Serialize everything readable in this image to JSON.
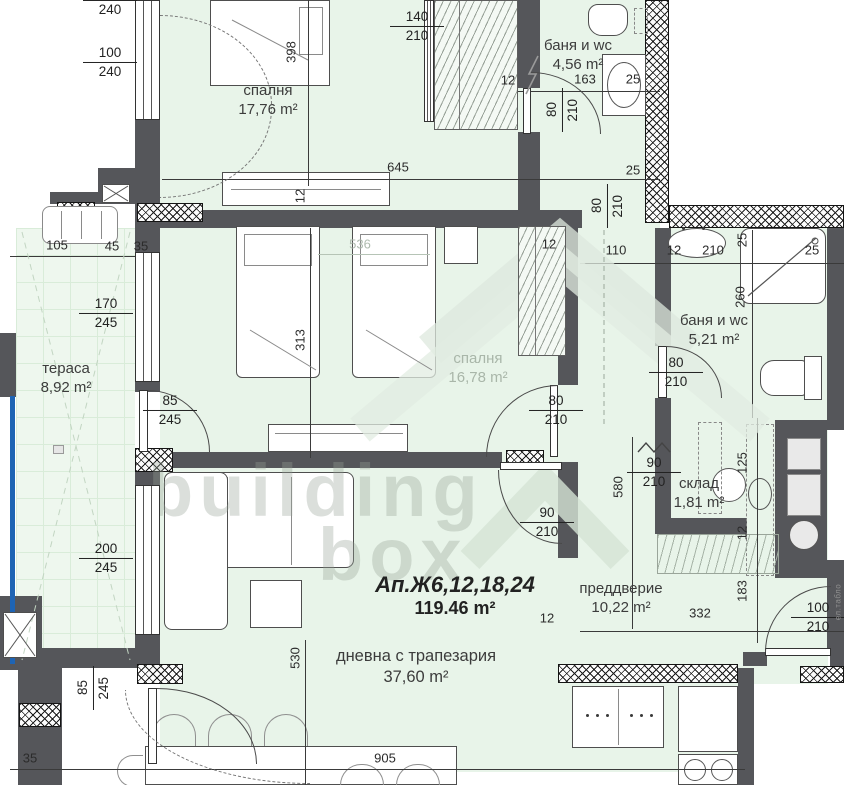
{
  "watermark": {
    "word1": "building",
    "word2": "box"
  },
  "title": {
    "apartment": "Ап.Ж6,12,18,24",
    "total_area": "119.46 m²"
  },
  "rooms": [
    {
      "name": "спалня",
      "area": "17,76 m²",
      "x": 268,
      "y": 82
    },
    {
      "name": "баня и wc",
      "area": "4,56 m²",
      "x": 578,
      "y": 37
    },
    {
      "name": "спалня",
      "area": "16,78 m²",
      "x": 478,
      "y": 350,
      "faded": true
    },
    {
      "name": "тераса",
      "area": "8,92 m²",
      "x": 66,
      "y": 360
    },
    {
      "name": "баня и wc",
      "area": "5,21 m²",
      "x": 714,
      "y": 312
    },
    {
      "name": "склад",
      "area": "1,81 m²",
      "x": 699,
      "y": 475
    },
    {
      "name": "преддверие",
      "area": "10,22 m²",
      "x": 621,
      "y": 580
    },
    {
      "name": "дневна с трапезария",
      "area": "37,60 m²",
      "x": 416,
      "y": 646,
      "big": true
    }
  ],
  "fractions": [
    {
      "num": "100",
      "den": "240",
      "x": 110,
      "y": 0
    },
    {
      "num": "100",
      "den": "240",
      "x": 110,
      "y": 62
    },
    {
      "num": "140",
      "den": "210",
      "x": 417,
      "y": 26
    },
    {
      "num": "80",
      "den": "210",
      "x": 562,
      "y": 110,
      "rot": true
    },
    {
      "num": "80",
      "den": "210",
      "x": 607,
      "y": 206,
      "rot": true
    },
    {
      "num": "80",
      "den": "210",
      "x": 556,
      "y": 410
    },
    {
      "num": "80",
      "den": "210",
      "x": 676,
      "y": 372
    },
    {
      "num": "90",
      "den": "210",
      "x": 547,
      "y": 522
    },
    {
      "num": "90",
      "den": "210",
      "x": 654,
      "y": 472
    },
    {
      "num": "170",
      "den": "245",
      "x": 106,
      "y": 313
    },
    {
      "num": "85",
      "den": "245",
      "x": 170,
      "y": 410
    },
    {
      "num": "200",
      "den": "245",
      "x": 106,
      "y": 558
    },
    {
      "num": "85",
      "den": "245",
      "x": 93,
      "y": 688,
      "rot": true
    },
    {
      "num": "100",
      "den": "210",
      "x": 818,
      "y": 617
    }
  ],
  "dims": [
    {
      "t": "398",
      "x": 291,
      "y": 52,
      "rot": true
    },
    {
      "t": "12",
      "x": 508,
      "y": 80
    },
    {
      "t": "163",
      "x": 585,
      "y": 79
    },
    {
      "t": "25",
      "x": 633,
      "y": 79
    },
    {
      "t": "645",
      "x": 398,
      "y": 167
    },
    {
      "t": "25",
      "x": 633,
      "y": 170
    },
    {
      "t": "12",
      "x": 300,
      "y": 196,
      "rot": true
    },
    {
      "t": "105",
      "x": 57,
      "y": 245
    },
    {
      "t": "45",
      "x": 112,
      "y": 246
    },
    {
      "t": "35",
      "x": 141,
      "y": 246
    },
    {
      "t": "536",
      "x": 360,
      "y": 244,
      "faded": true
    },
    {
      "t": "12",
      "x": 549,
      "y": 244
    },
    {
      "t": "110",
      "x": 616,
      "y": 250
    },
    {
      "t": "12",
      "x": 674,
      "y": 250
    },
    {
      "t": "210",
      "x": 713,
      "y": 250
    },
    {
      "t": "25",
      "x": 742,
      "y": 240,
      "rot": true
    },
    {
      "t": "25",
      "x": 812,
      "y": 250
    },
    {
      "t": "260",
      "x": 740,
      "y": 297,
      "rot": true
    },
    {
      "t": "313",
      "x": 300,
      "y": 340,
      "rot": true
    },
    {
      "t": "580",
      "x": 618,
      "y": 487,
      "rot": true
    },
    {
      "t": "125",
      "x": 742,
      "y": 463,
      "rot": true
    },
    {
      "t": "12",
      "x": 742,
      "y": 533,
      "rot": true
    },
    {
      "t": "183",
      "x": 742,
      "y": 591,
      "rot": true
    },
    {
      "t": "332",
      "x": 700,
      "y": 613
    },
    {
      "t": "12",
      "x": 547,
      "y": 618
    },
    {
      "t": "530",
      "x": 295,
      "y": 658,
      "rot": true
    },
    {
      "t": "905",
      "x": 385,
      "y": 758
    },
    {
      "t": "35",
      "x": 30,
      "y": 758
    },
    {
      "t": "ел.табло",
      "x": 838,
      "y": 602,
      "rot": true,
      "tiny": true
    }
  ]
}
